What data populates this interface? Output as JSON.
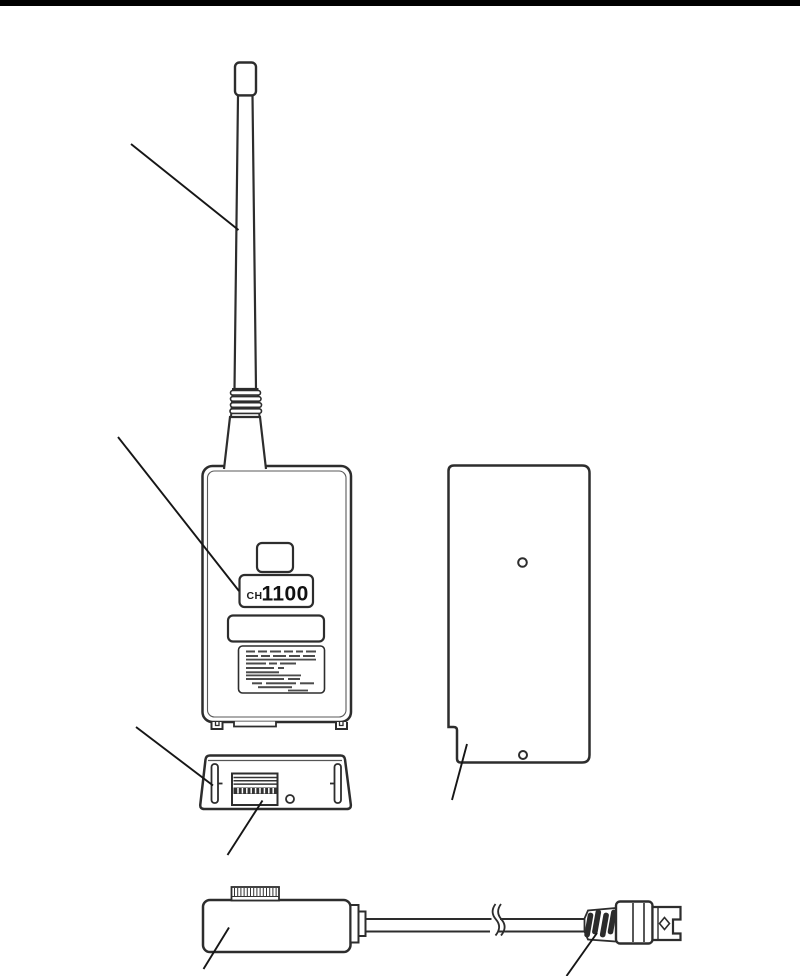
{
  "page": {
    "background_color": "#ffffff",
    "top_bar_color": "#000000",
    "line_color": "#2d2d2d",
    "callout_color": "#161616"
  },
  "device_label": {
    "prefix": "CH",
    "number": "1100"
  }
}
